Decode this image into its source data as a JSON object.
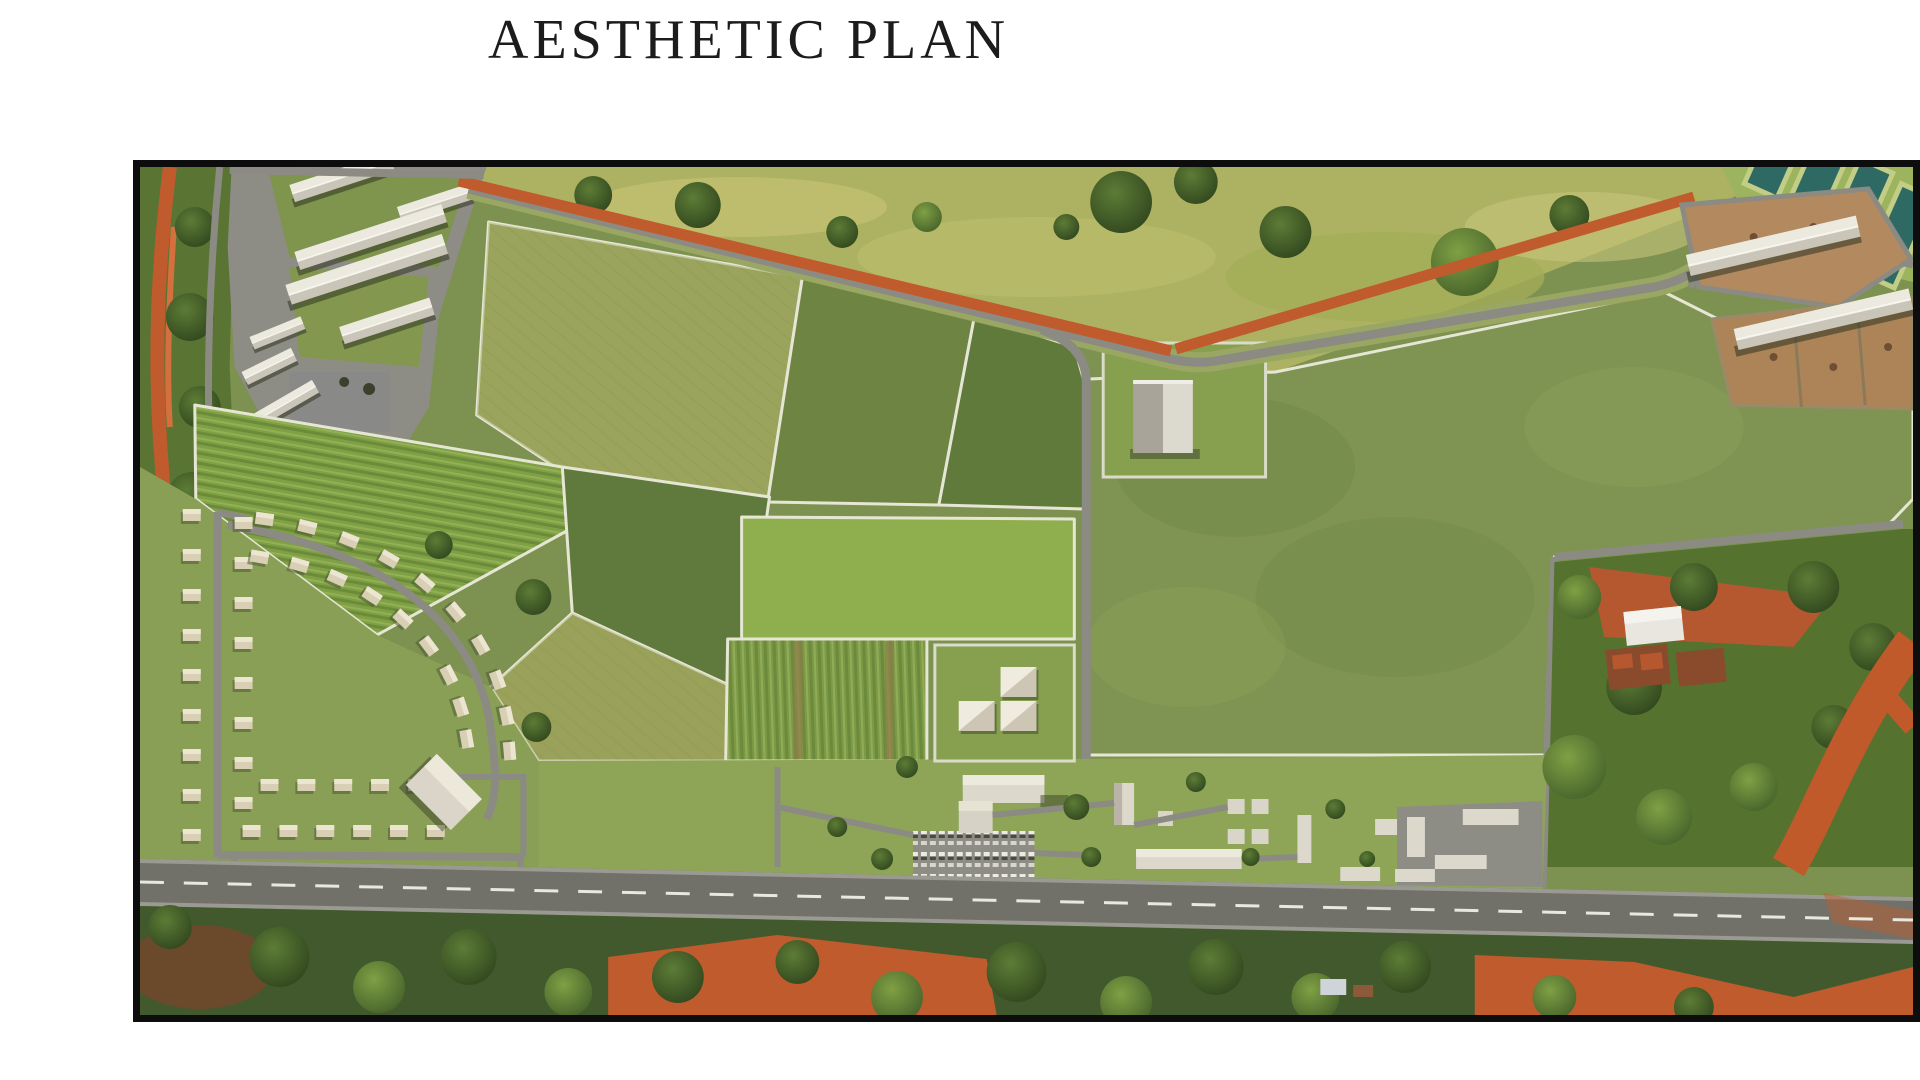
{
  "page": {
    "background": "#ffffff",
    "title": "AESTHETIC PLAN"
  },
  "site_plan": {
    "kind": "aerial-masterplan-render",
    "frame_border_color": "#0d0d0d",
    "palette": {
      "field_base": "#7d9150",
      "field_bright": "#8fae4e",
      "field_dark": "#5f7a3b",
      "field_olive": "#9aa45c",
      "wild_grass": "#adb262",
      "road_gray": "#8b8b83",
      "asphalt": "#71716a",
      "dirt_red": "#bf5b2d",
      "pond_teal": "#2e6a63",
      "roof_white": "#dcd8cc",
      "dirt_brown": "#b3895f",
      "tree_dark": "#33491f"
    },
    "zones": [
      "wild-grassland",
      "industrial-sheds",
      "crop-parcels",
      "crescent-housing",
      "central-farmstead",
      "big-pasture",
      "poultry-compound",
      "fish-ponds",
      "village",
      "perimeter-road",
      "main-road",
      "tree-belt"
    ]
  }
}
